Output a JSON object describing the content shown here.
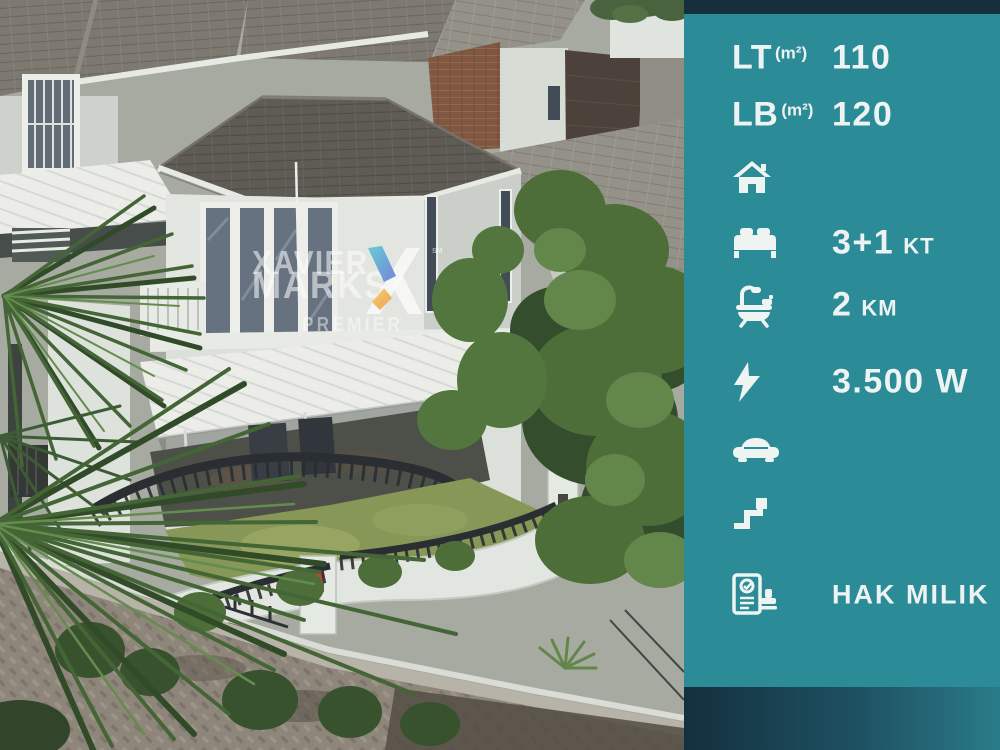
{
  "watermark": {
    "line1": "XAVIER",
    "line2": "MARKS",
    "sub": "PREMIER",
    "mark": "SM",
    "accent_teal": "#35c4d3",
    "accent_orange": "#f2a13d"
  },
  "panel": {
    "background_color": "#2b8b97",
    "top_strip_color": "#152f3b",
    "footer_gradient": [
      "#14303e",
      "#2a7b89"
    ],
    "text_color": "#edf3f2",
    "rows": {
      "lt": {
        "label": "LT",
        "unit": "(m²)",
        "value": "110"
      },
      "lb": {
        "label": "LB",
        "unit": "(m²)",
        "value": "120"
      },
      "house": {
        "icon": "house-icon"
      },
      "bedrooms": {
        "icon": "bed-icon",
        "value": "3+1",
        "suffix": "KT"
      },
      "bathrooms": {
        "icon": "bath-icon",
        "value": "2",
        "suffix": "KM"
      },
      "power": {
        "icon": "lightning-icon",
        "value": "3.500 W"
      },
      "carport": {
        "icon": "car-icon"
      },
      "floors": {
        "icon": "stairs-icon"
      },
      "certificate": {
        "icon": "certificate-icon",
        "value": "HAK MILIK"
      }
    }
  }
}
